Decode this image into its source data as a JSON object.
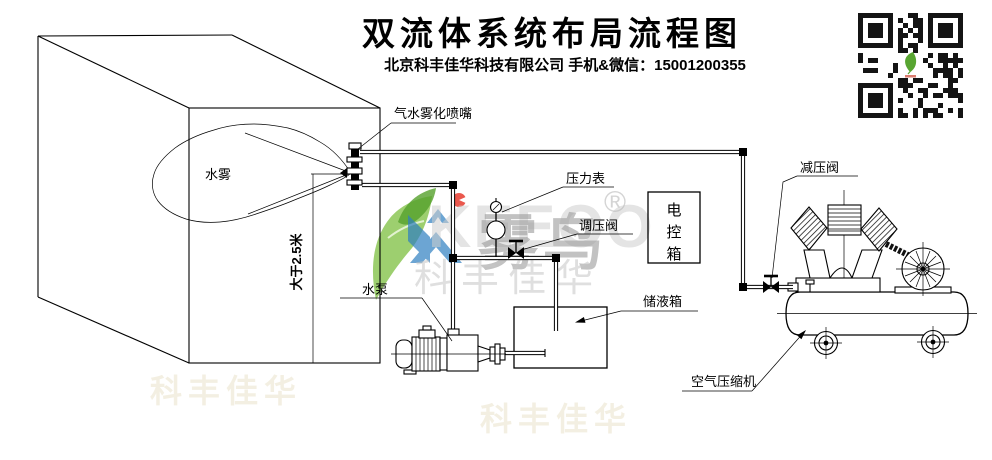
{
  "header": {
    "title": "双流体系统布局流程图",
    "subtitle": "北京科丰佳华科技有限公司 手机&微信：15001200355"
  },
  "labels": {
    "nozzle": "气水雾化喷嘴",
    "mist": "水雾",
    "height": "大于2.5米",
    "pressure_gauge": "压力表",
    "regulating_valve": "调压阀",
    "control_box": "电控箱",
    "control_box_chars": [
      "电",
      "控",
      "箱"
    ],
    "storage_tank": "储液箱",
    "water_pump": "水泵",
    "reducing_valve": "减压阀",
    "air_compressor": "空气压缩机"
  },
  "watermark": {
    "latin": "KEEOO",
    "brand": "雾鸟",
    "company": "科丰佳华",
    "registered": "®"
  },
  "colors": {
    "line": "#000000",
    "leaf_green": "#7cbf3f",
    "leaf_dark": "#55a02c",
    "logo_blue": "#2f7fc1",
    "logo_red": "#e73b2f",
    "watermark_gray": "#9b9b9b",
    "qr_dark": "#141414"
  }
}
